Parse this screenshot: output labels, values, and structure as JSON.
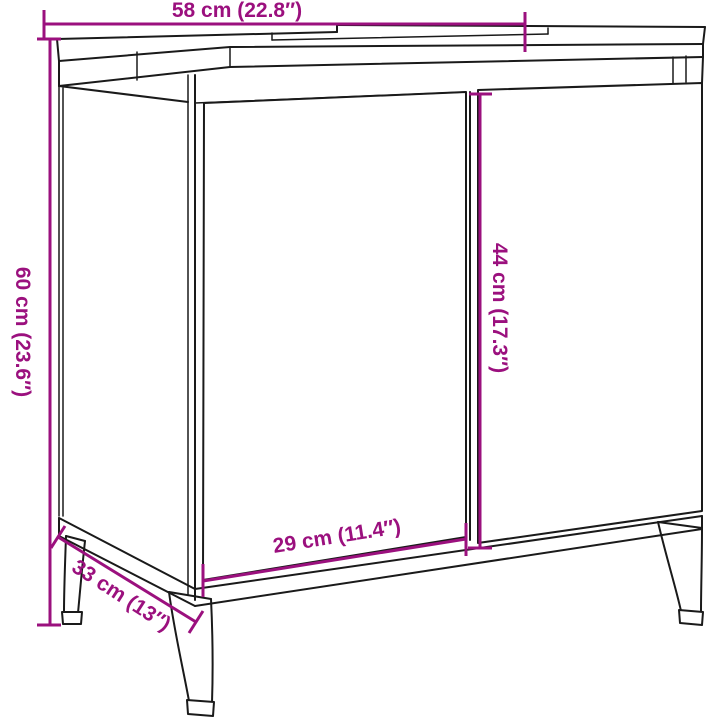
{
  "diagram": {
    "kind": "furniture-dimension-diagram",
    "dimensions": {
      "width": "58 cm (22.8″)",
      "height": "60 cm (23.6″)",
      "door_height": "44 cm (17.3″)",
      "door_width": "29 cm (11.4″)",
      "depth": "33 cm (13″)"
    },
    "colors": {
      "dimension_accent": "#9b107e",
      "outline": "#1a1a1a",
      "background": "#ffffff"
    }
  }
}
